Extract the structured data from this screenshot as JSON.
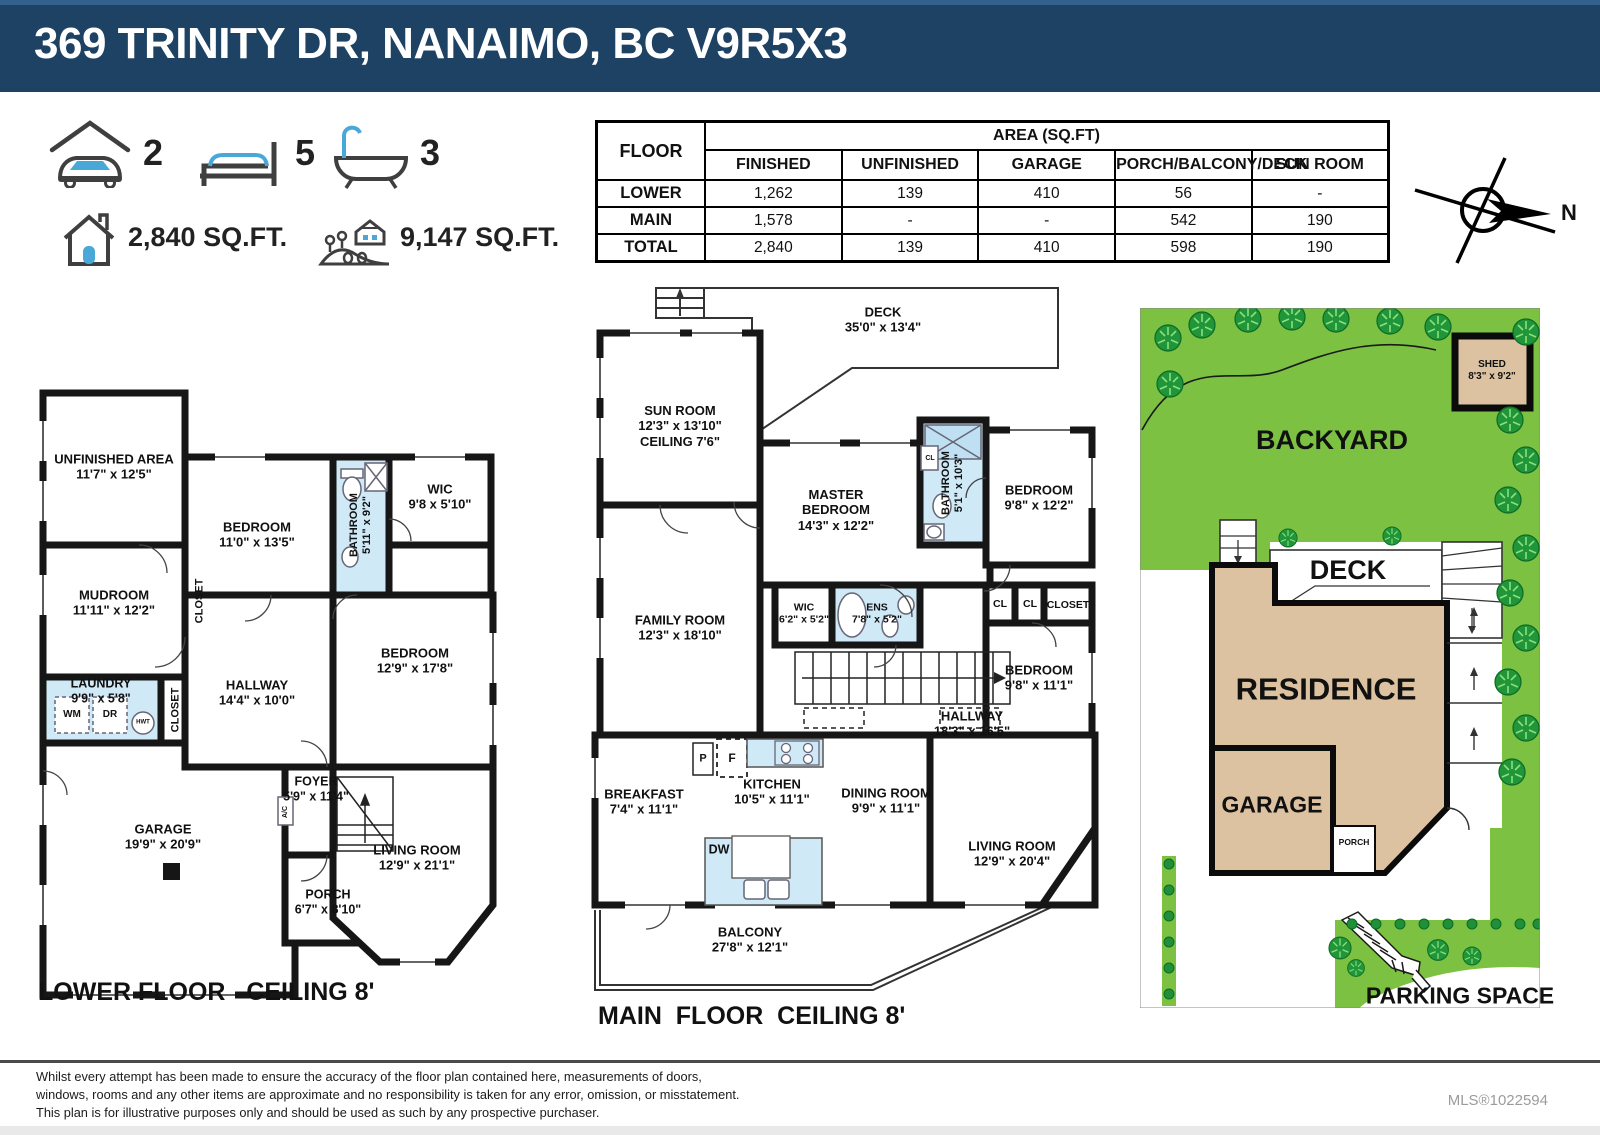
{
  "header": {
    "title": "369 TRINITY DR, NANAIMO, BC V9R5X3"
  },
  "summary": {
    "garage_count": "2",
    "bed_count": "5",
    "bath_count": "3",
    "house_sqft": "2,840 SQ.FT.",
    "lot_sqft": "9,147 SQ.FT."
  },
  "area_table": {
    "floor_header": "FLOOR",
    "area_header": "AREA (SQ.FT)",
    "columns": [
      "FINISHED",
      "UNFINISHED",
      "GARAGE",
      "PORCH/BALCONY/DECK",
      "SUN ROOM"
    ],
    "rows": [
      {
        "floor": "LOWER",
        "values": [
          "1,262",
          "139",
          "410",
          "56",
          "-"
        ]
      },
      {
        "floor": "MAIN",
        "values": [
          "1,578",
          "-",
          "-",
          "542",
          "190"
        ]
      },
      {
        "floor": "TOTAL",
        "values": [
          "2,840",
          "139",
          "410",
          "598",
          "190"
        ]
      }
    ]
  },
  "compass": {
    "label": "N"
  },
  "plans": {
    "lower": {
      "caption": "LOWER FLOOR   CEILING 8'",
      "labels": [
        {
          "lines": [
            "UNFINISHED AREA",
            "11'7\" x 12'5\""
          ],
          "x": 79,
          "y": 82
        },
        {
          "lines": [
            "BEDROOM",
            "11'0\" x 13'5\""
          ],
          "x": 222,
          "y": 150
        },
        {
          "lines": [
            "BATHROOM",
            "5'11\" x 9'2\""
          ],
          "x": 326,
          "y": 140,
          "rot": -90,
          "fs": 11
        },
        {
          "lines": [
            "WIC",
            "9'8 x 5'10\""
          ],
          "x": 405,
          "y": 112
        },
        {
          "lines": [
            "MUDROOM",
            "11'11\" x 12'2\""
          ],
          "x": 79,
          "y": 218
        },
        {
          "lines": [
            "CLOSET"
          ],
          "x": 165,
          "y": 216,
          "rot": -90,
          "fs": 11
        },
        {
          "lines": [
            "LAUNDRY",
            "9'9\" x 5'8\""
          ],
          "x": 66,
          "y": 306,
          "fs": 12.5
        },
        {
          "lines": [
            "WM"
          ],
          "x": 37,
          "y": 330,
          "fs": 10
        },
        {
          "lines": [
            "DR"
          ],
          "x": 75,
          "y": 330,
          "fs": 10
        },
        {
          "lines": [
            "HWT"
          ],
          "x": 108,
          "y": 338,
          "fs": 6
        },
        {
          "lines": [
            "CLOSET"
          ],
          "x": 141,
          "y": 325,
          "rot": -90,
          "fs": 11
        },
        {
          "lines": [
            "HALLWAY",
            "14'4\" x 10'0\""
          ],
          "x": 222,
          "y": 308
        },
        {
          "lines": [
            "BEDROOM",
            "12'9\" x 17'8\""
          ],
          "x": 380,
          "y": 276
        },
        {
          "lines": [
            "FOYER",
            "5'9\" x 11'4\""
          ],
          "x": 281,
          "y": 404,
          "fs": 12.5
        },
        {
          "lines": [
            "A/C"
          ],
          "x": 251,
          "y": 427,
          "rot": -90,
          "fs": 7
        },
        {
          "lines": [
            "GARAGE",
            "19'9\" x 20'9\""
          ],
          "x": 128,
          "y": 452
        },
        {
          "lines": [
            "PORCH",
            "6'7\" x 8'10\""
          ],
          "x": 293,
          "y": 517,
          "fs": 12.5
        },
        {
          "lines": [
            "LIVING ROOM",
            "12'9\" x 21'1\""
          ],
          "x": 382,
          "y": 473
        }
      ]
    },
    "main": {
      "caption": "MAIN  FLOOR  CEILING 8'",
      "labels": [
        {
          "lines": [
            "DECK",
            "35'0\" x 13'4\""
          ],
          "x": 303,
          "y": 42
        },
        {
          "lines": [
            "SUN ROOM",
            "12'3\" x 13'10\"",
            "CEILING 7'6\""
          ],
          "x": 100,
          "y": 148
        },
        {
          "lines": [
            "MASTER",
            "BEDROOM",
            "14'3\" x 12'2\""
          ],
          "x": 256,
          "y": 232
        },
        {
          "lines": [
            "BATHROOM",
            "5'1\" x 10'3\""
          ],
          "x": 373,
          "y": 205,
          "rot": -90,
          "fs": 11
        },
        {
          "lines": [
            "CL"
          ],
          "x": 350,
          "y": 181,
          "fs": 7
        },
        {
          "lines": [
            "BEDROOM",
            "9'8\" x 12'2\""
          ],
          "x": 459,
          "y": 220
        },
        {
          "lines": [
            "FAMILY ROOM",
            "12'3\" x 18'10\""
          ],
          "x": 100,
          "y": 350
        },
        {
          "lines": [
            "WIC",
            "6'2\" x 5'2\""
          ],
          "x": 224,
          "y": 336,
          "fs": 10.5
        },
        {
          "lines": [
            "ENS",
            "7'8\" x 5'2\""
          ],
          "x": 297,
          "y": 336,
          "fs": 10.5
        },
        {
          "lines": [
            "CL"
          ],
          "x": 420,
          "y": 326,
          "fs": 10.5
        },
        {
          "lines": [
            "CL"
          ],
          "x": 450,
          "y": 326,
          "fs": 10.5
        },
        {
          "lines": [
            "CLOSET"
          ],
          "x": 488,
          "y": 327,
          "fs": 10.5
        },
        {
          "lines": [
            "BEDROOM",
            "9'8\" x 11'1\""
          ],
          "x": 459,
          "y": 400
        },
        {
          "lines": [
            "HALLWAY",
            "18'3\" x 16'5\""
          ],
          "x": 392,
          "y": 446
        },
        {
          "lines": [
            "P"
          ],
          "x": 123,
          "y": 481,
          "fs": 11
        },
        {
          "lines": [
            "F"
          ],
          "x": 152,
          "y": 480,
          "fs": 12
        },
        {
          "lines": [
            "KITCHEN",
            "10'5\" x 11'1\""
          ],
          "x": 192,
          "y": 514
        },
        {
          "lines": [
            "DW"
          ],
          "x": 139,
          "y": 572,
          "fs": 12.5
        },
        {
          "lines": [
            "BREAKFAST",
            "7'4\" x 11'1\""
          ],
          "x": 64,
          "y": 524
        },
        {
          "lines": [
            "DINING ROOM",
            "9'9\" x 11'1\""
          ],
          "x": 306,
          "y": 523
        },
        {
          "lines": [
            "LIVING ROOM",
            "12'9\" x 20'4\""
          ],
          "x": 432,
          "y": 576
        },
        {
          "lines": [
            "BALCONY",
            "27'8\" x 12'1\""
          ],
          "x": 170,
          "y": 662
        }
      ]
    },
    "site": {
      "labels": [
        {
          "lines": [
            "SHED",
            "8'3\" x 9'2\""
          ],
          "x": 352,
          "y": 63,
          "fs": 10,
          "n": "shed-label"
        },
        {
          "lines": [
            "BACKYARD"
          ],
          "x": 192,
          "y": 133,
          "fs": 27,
          "n": "backyard-label"
        },
        {
          "lines": [
            "DECK"
          ],
          "x": 208,
          "y": 263,
          "fs": 27,
          "n": "deck-label"
        },
        {
          "lines": [
            "RESIDENCE"
          ],
          "x": 186,
          "y": 382,
          "fs": 31,
          "n": "residence-label"
        },
        {
          "lines": [
            "GARAGE"
          ],
          "x": 132,
          "y": 497,
          "fs": 23,
          "n": "garage-label"
        },
        {
          "lines": [
            "PORCH"
          ],
          "x": 214,
          "y": 534,
          "fs": 8.5,
          "n": "porch-label"
        },
        {
          "lines": [
            "PARKING SPACE"
          ],
          "x": 320,
          "y": 688,
          "fs": 23,
          "n": "parking-label"
        }
      ]
    }
  },
  "footer": {
    "line1": "Whilst every attempt has been made to ensure the accuracy of the floor plan contained here, measurements of doors,",
    "line2": "windows, rooms and any other items are approximate and no responsibility is taken for any error, omission, or misstatement.",
    "line3": "This plan is for illustrative purposes only and should be used as such by any prospective purchaser.",
    "mls": "MLS®1022594"
  }
}
